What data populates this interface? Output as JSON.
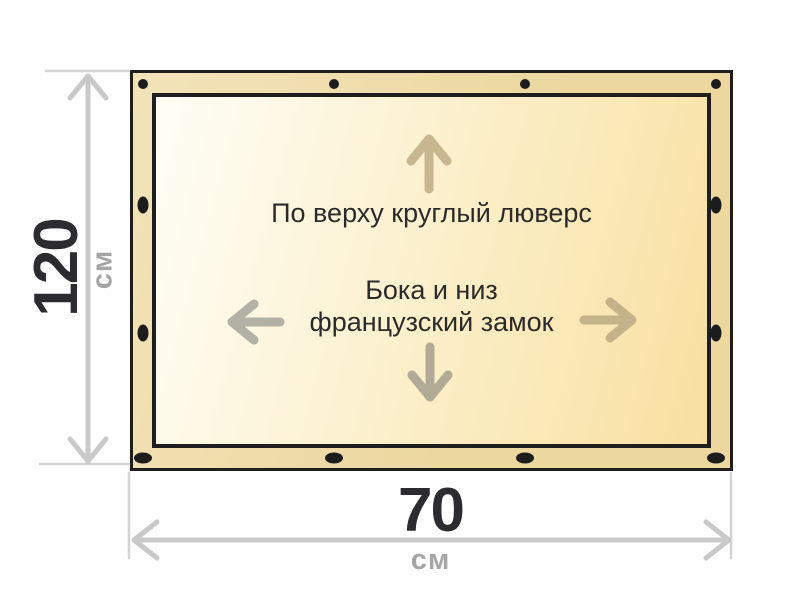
{
  "banner": {
    "top_note": "По верху круглый люверс",
    "middle_note": {
      "line1": "Бока и низ",
      "line2": "французский замок"
    }
  },
  "dimensions": {
    "height": {
      "value": "120",
      "unit": "см"
    },
    "width": {
      "value": "70",
      "unit": "см"
    }
  },
  "colors": {
    "outline": "#1e1e1e",
    "band": "#ecd79f",
    "band_light": "#f3e3ba",
    "panel_light": "#fffef7",
    "panel_mid": "#fbeec6",
    "panel_dark": "#f8dfa0",
    "dot": "#1c1c1c",
    "note_text": "#2b2b2b",
    "value_text": "#2b2b30",
    "unit_text": "#a5a5a5",
    "dim_line": "#c9c9c9",
    "ext_line": "#d4d4d4",
    "arrow_up": "#c7b68e",
    "arrow_right": "#c3b28a",
    "arrow_left": "#b3b0a5",
    "arrow_down": "#b1aa96"
  }
}
